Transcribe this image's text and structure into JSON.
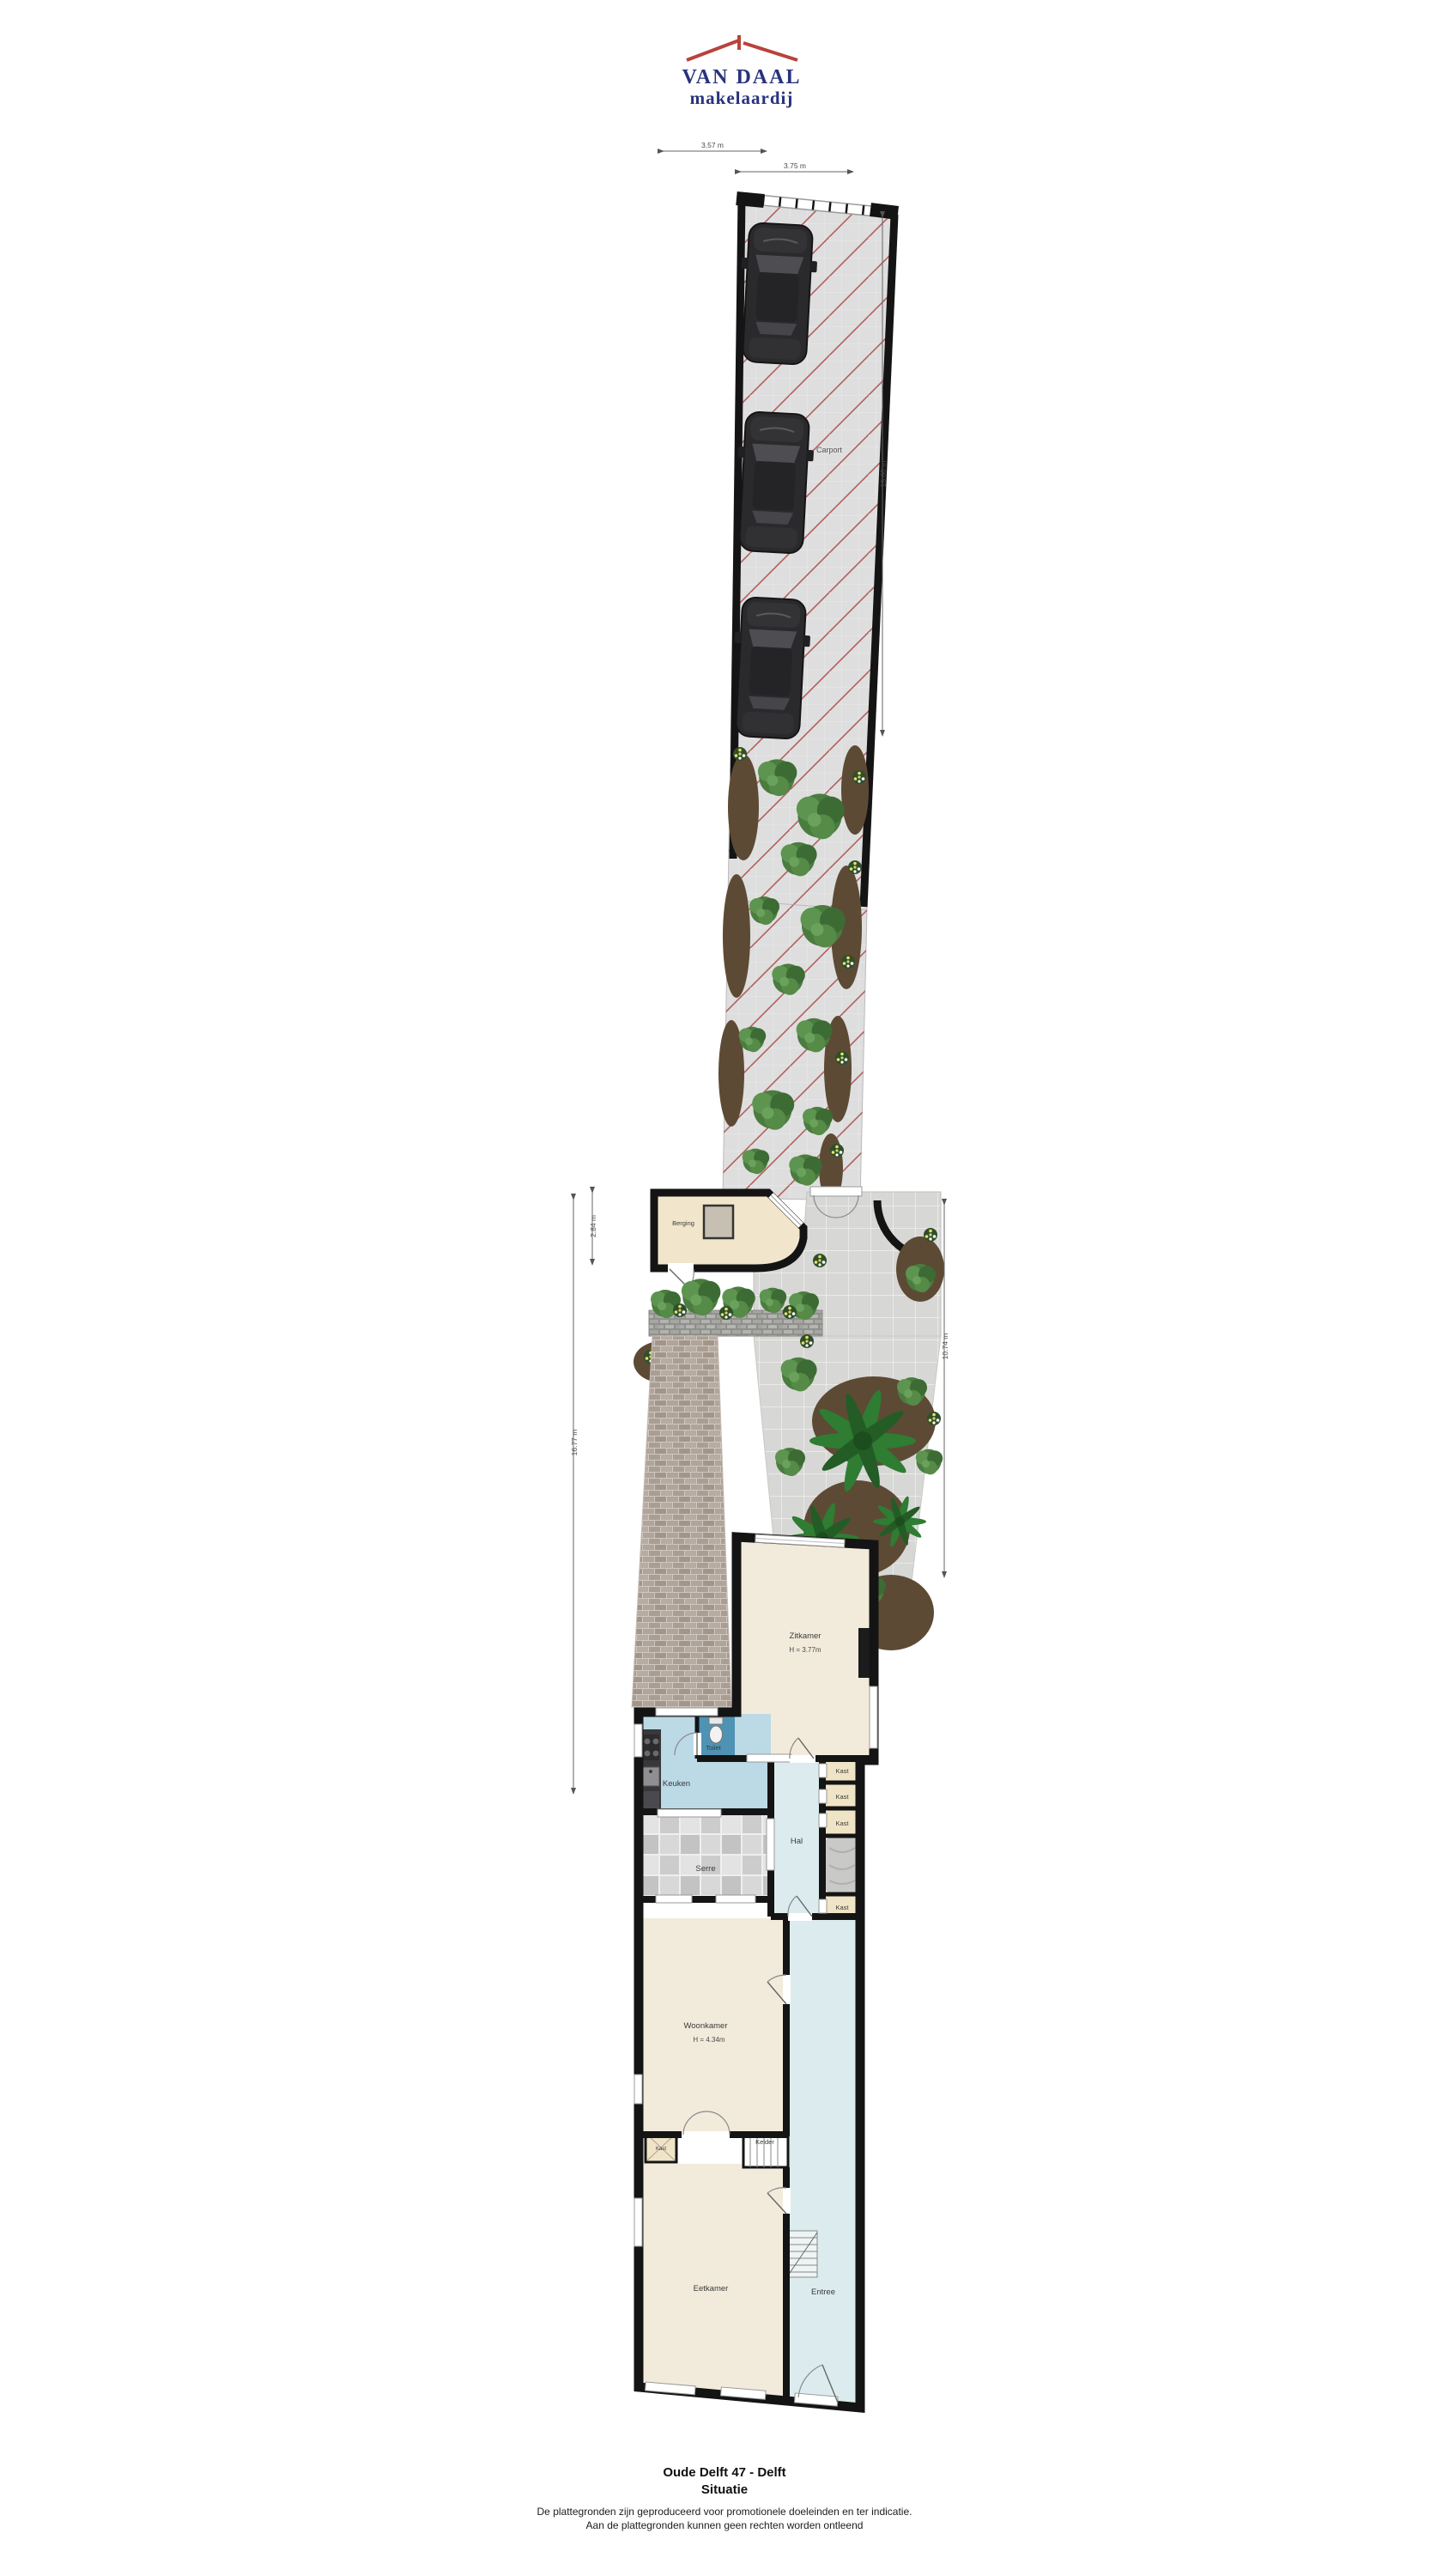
{
  "logo": {
    "title": "VAN DAAL",
    "subtitle": "makelaardij",
    "colors": {
      "roof_red": "#b8433c",
      "text_blue": "#28337c"
    }
  },
  "plan": {
    "dimensions": {
      "top1": "3.57 m",
      "top2": "3.75 m",
      "carport_right": "15.60 m",
      "berging_left": "2.84 m",
      "garden_left": "16.77 m",
      "garden_right": "10.74 m"
    },
    "areas": {
      "carport": "Carport",
      "berging": "Berging",
      "zitkamer": "Zitkamer",
      "zitkamer_height": "H = 3.77m",
      "toilet": "Toilet",
      "keuken": "Keuken",
      "serre": "Serre",
      "hal": "Hal",
      "kast_labels": [
        "Kast",
        "Kast",
        "Kast",
        "Kast",
        "Kast"
      ],
      "woonkamer": "Woonkamer",
      "woonkamer_height": "H = 4.34m",
      "kelder": "Kelder",
      "eetkamer": "Eetkamer",
      "entree": "Entree"
    },
    "colors": {
      "wall": "#141414",
      "room_beige": "#f2ebdc",
      "kitchen_blue": "#bcd9e6",
      "hall_blue": "#dcecee",
      "toilet_blue": "#4e93b4",
      "kast_beige": "#f0e4c6",
      "carport_grey": "#dedede",
      "hatch_red": "#b2605f",
      "plant_green": "#4a7c3f",
      "soil_brown": "#5d4a35"
    }
  },
  "footer": {
    "title": "Oude Delft 47 - Delft",
    "subtitle": "Situatie",
    "disclaimer1": "De plattegronden zijn geproduceerd voor promotionele doeleinden en ter indicatie.",
    "disclaimer2": "Aan de plattegronden kunnen geen rechten worden ontleend"
  }
}
